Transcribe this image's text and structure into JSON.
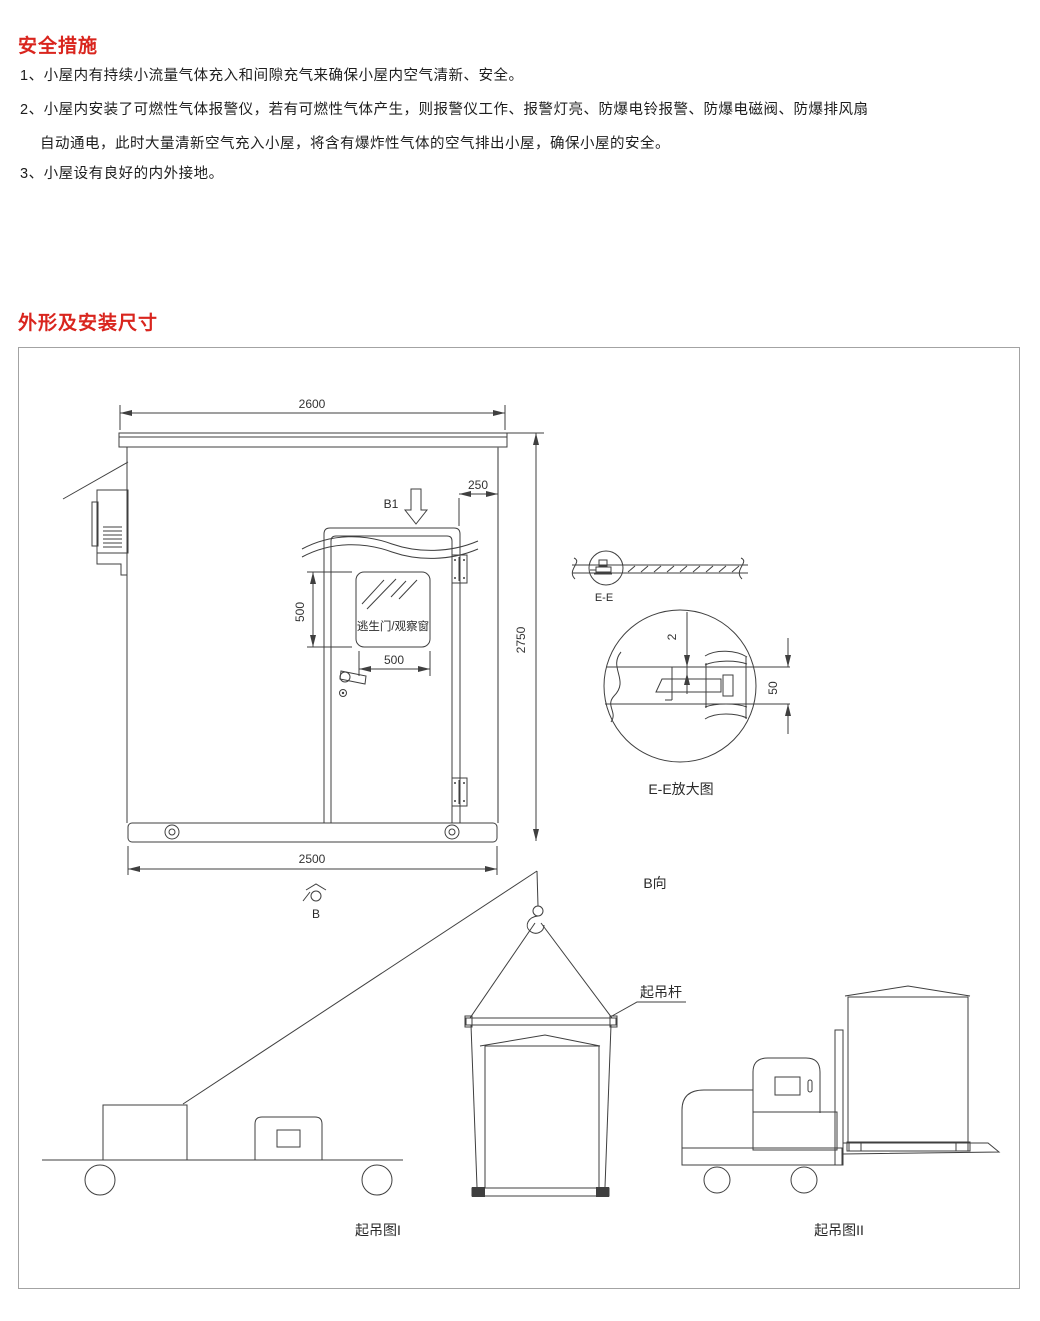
{
  "sections": {
    "safety": {
      "title": "安全措施",
      "lines": [
        "1、小屋内有持续小流量气体充入和间隙充气来确保小屋内空气清新、安全。",
        "2、小屋内安装了可燃性气体报警仪，若有可燃性气体产生，则报警仪工作、报警灯亮、防爆电铃报警、防爆电磁阀、防爆排风扇",
        "自动通电，此时大量清新空气充入小屋，将含有爆炸性气体的空气排出小屋，确保小屋的安全。",
        "3、小屋设有良好的内外接地。"
      ]
    },
    "dimensions": {
      "title": "外形及安装尺寸"
    }
  },
  "drawing": {
    "front_view": {
      "dim_roof_width": "2600",
      "dim_door_offset": "250",
      "dim_window_height": "500",
      "dim_window_width": "500",
      "dim_total_height": "2750",
      "dim_base_width": "2500",
      "door_window_label": "逃生门/观察窗",
      "view_arrow_label": "B1",
      "view_point_label": "B"
    },
    "section_view": {
      "label": "E-E",
      "detail_label": "E-E放大图",
      "dim_gap": "2",
      "dim_panel": "50",
      "view_label": "B向"
    },
    "lifting": {
      "beam_label": "起吊杆",
      "fig1_label": "起吊图I",
      "fig2_label": "起吊图II"
    }
  },
  "colors": {
    "accent": "#d9251e",
    "line": "#3f3f3f"
  }
}
